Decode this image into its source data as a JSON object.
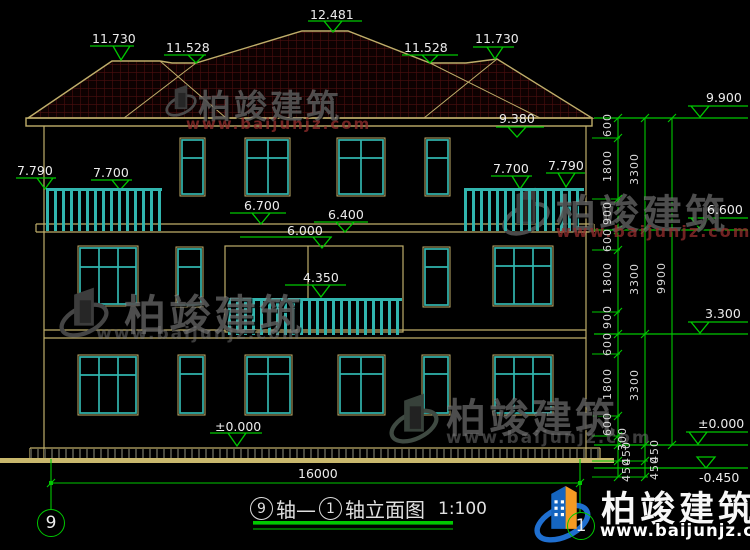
{
  "watermark": {
    "brand": "柏竣建筑",
    "url": "www.baijunjz.com"
  },
  "levels": {
    "peak": "12.481",
    "ridge_left": "11.730",
    "flat_left": "11.528",
    "flat_right": "11.528",
    "ridge_right": "11.730",
    "eave": "9.380",
    "parapet": "9.900",
    "balcony3_left_outer": "7.790",
    "balcony3_left_inner": "7.700",
    "balcony3_right_inner": "7.700",
    "balcony3_right_outer": "7.790",
    "canopy_left": "6.700",
    "canopy_right": "6.400",
    "floor3": "6.000",
    "level_66": "6.600",
    "balcony2": "4.350",
    "level_33": "3.300",
    "ground_left": "±0.000",
    "ground_right": "±0.000",
    "basement": "-0.450"
  },
  "dimensions": {
    "chain": [
      "600",
      "1800",
      "900",
      "600",
      "1800",
      "900",
      "600",
      "1800",
      "600",
      "300"
    ],
    "sub": [
      "450",
      "450",
      "450",
      "450"
    ],
    "floors": [
      "3300",
      "3300",
      "3300"
    ],
    "total_height": "9900",
    "total_width": "16000"
  },
  "title": {
    "axis_start": "9",
    "mid": "轴—",
    "axis_end": "1",
    "rest": "轴立面图",
    "scale": "1:100"
  },
  "axes": {
    "left": "9",
    "right": "1"
  }
}
